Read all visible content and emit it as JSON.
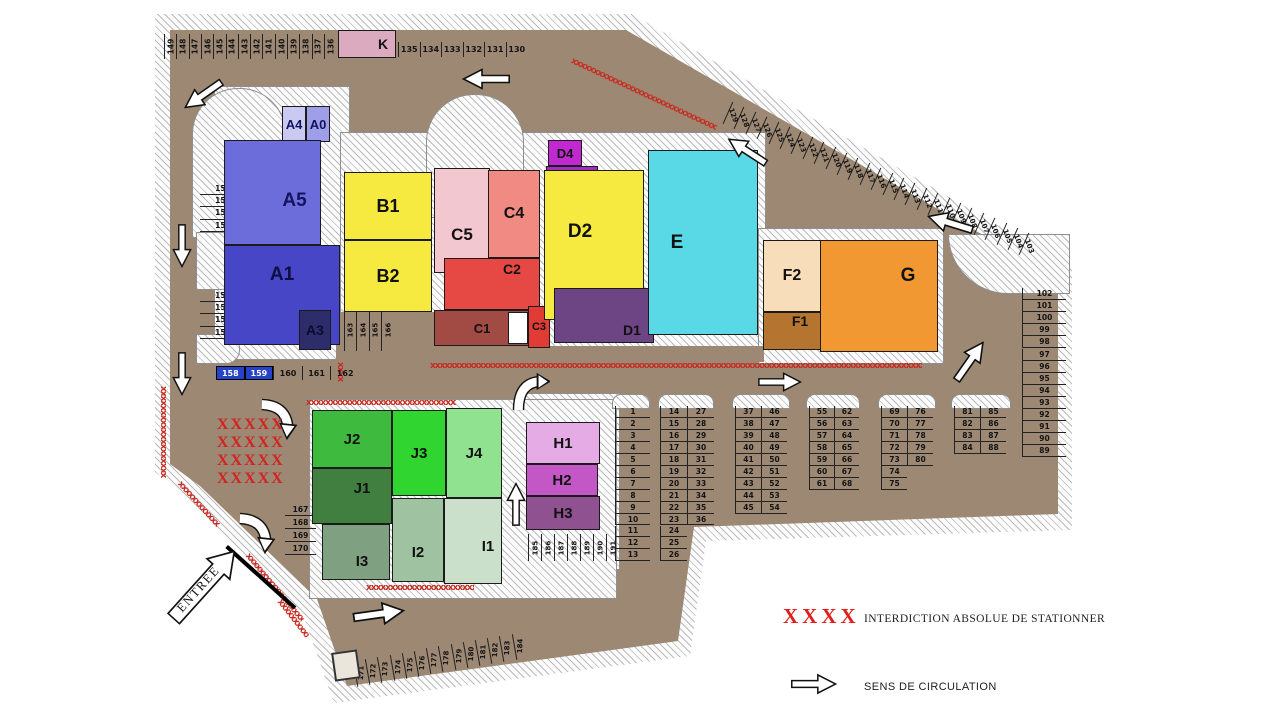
{
  "legend": {
    "no_parking_symbol": "XXXX",
    "no_parking_label": "INTERDICTION ABSOLUE DE STATIONNER",
    "direction_label": "SENS DE CIRCULATION"
  },
  "entrance_label": "ENTREE",
  "no_parking_rows": [
    "XXXXX",
    "XXXXX",
    "XXXXX",
    "XXXXX"
  ],
  "colors": {
    "road": "#9c8873",
    "no_parking_red": "#c92a21",
    "legend_red": "#e21d1d",
    "reserved_spot_blue": "#2642c8"
  },
  "buildings": [
    {
      "id": "A4",
      "label": "A4",
      "x": 282,
      "y": 106,
      "w": 24,
      "h": 36,
      "bg": "#c9c9f1",
      "fg": "#14145e",
      "fs": 13
    },
    {
      "id": "A0",
      "label": "A0",
      "x": 306,
      "y": 106,
      "w": 24,
      "h": 36,
      "bg": "#9e9ee9",
      "fg": "#14145e",
      "fs": 13
    },
    {
      "id": "A5",
      "label": "A5",
      "x": 224,
      "y": 140,
      "w": 97,
      "h": 105,
      "bg": "#6c6cdb",
      "fg": "#14145e",
      "fs": 19,
      "dx": 22,
      "dy": 8
    },
    {
      "id": "A1",
      "label": "A1",
      "x": 224,
      "y": 245,
      "w": 116,
      "h": 100,
      "bg": "#4646c6",
      "fg": "#0f0f40",
      "fs": 19,
      "dy": -20
    },
    {
      "id": "A3",
      "label": "A3",
      "x": 299,
      "y": 310,
      "w": 32,
      "h": 40,
      "bg": "#2d2d6b",
      "fg": "#0b0b30",
      "fs": 14
    },
    {
      "id": "B1",
      "label": "B1",
      "x": 344,
      "y": 172,
      "w": 88,
      "h": 68,
      "bg": "#f6e93f",
      "fg": "#111111",
      "fs": 18
    },
    {
      "id": "B2",
      "label": "B2",
      "x": 344,
      "y": 240,
      "w": 88,
      "h": 72,
      "bg": "#f6e93f",
      "fg": "#111111",
      "fs": 18
    },
    {
      "id": "C5",
      "label": "C5",
      "x": 434,
      "y": 168,
      "w": 56,
      "h": 105,
      "bg": "#f3c7cf",
      "fg": "#111111",
      "fs": 17,
      "dy": 14
    },
    {
      "id": "C4",
      "label": "C4",
      "x": 488,
      "y": 170,
      "w": 52,
      "h": 88,
      "bg": "#f28a84",
      "fg": "#111111",
      "fs": 16
    },
    {
      "id": "C2",
      "label": "C2",
      "x": 444,
      "y": 258,
      "w": 96,
      "h": 52,
      "bg": "#e64843",
      "fg": "#111111",
      "fs": 14,
      "dx": 20,
      "dy": -15
    },
    {
      "id": "C1",
      "label": "C1",
      "x": 434,
      "y": 310,
      "w": 96,
      "h": 36,
      "bg": "#a24a44",
      "fg": "#111111",
      "fs": 13
    },
    {
      "id": "GAP",
      "label": "",
      "x": 508,
      "y": 312,
      "w": 20,
      "h": 32,
      "bg": "#ffffff"
    },
    {
      "id": "C3",
      "label": "C3",
      "x": 528,
      "y": 306,
      "w": 22,
      "h": 42,
      "bg": "#e03b35",
      "fg": "#111111",
      "fs": 11
    },
    {
      "id": "D4",
      "label": "D4",
      "x": 548,
      "y": 140,
      "w": 34,
      "h": 26,
      "bg": "#bf29cf",
      "fg": "#111111",
      "fs": 13
    },
    {
      "id": "D4b",
      "label": "",
      "x": 546,
      "y": 166,
      "w": 52,
      "h": 22,
      "bg": "#a12cc0"
    },
    {
      "id": "D2",
      "label": "D2",
      "x": 544,
      "y": 170,
      "w": 100,
      "h": 150,
      "bg": "#f6e93f",
      "fg": "#111111",
      "fs": 19,
      "dx": -14,
      "dy": -13
    },
    {
      "id": "D1",
      "label": "D1",
      "x": 554,
      "y": 288,
      "w": 100,
      "h": 55,
      "bg": "#6d4585",
      "fg": "#101010",
      "fs": 14,
      "dx": 28,
      "dy": 14
    },
    {
      "id": "E",
      "label": "E",
      "x": 648,
      "y": 150,
      "w": 110,
      "h": 185,
      "bg": "#59d9e6",
      "fg": "#111111",
      "fs": 19,
      "dx": -26
    },
    {
      "id": "F2",
      "label": "F2",
      "x": 763,
      "y": 240,
      "w": 58,
      "h": 72,
      "bg": "#f7ddb9",
      "fg": "#111111",
      "fs": 16
    },
    {
      "id": "F1",
      "label": "F1",
      "x": 763,
      "y": 312,
      "w": 58,
      "h": 38,
      "bg": "#b5742f",
      "fg": "#111111",
      "fs": 14,
      "dx": 8,
      "dy": -10
    },
    {
      "id": "G",
      "label": "G",
      "x": 820,
      "y": 240,
      "w": 118,
      "h": 112,
      "bg": "#f29833",
      "fg": "#111111",
      "fs": 19,
      "dx": 29,
      "dy": -20
    },
    {
      "id": "K",
      "label": "K",
      "x": 338,
      "y": 30,
      "w": 58,
      "h": 28,
      "bg": "#dcaabe",
      "fg": "#111111",
      "fs": 14,
      "dx": 16
    },
    {
      "id": "H1",
      "label": "H1",
      "x": 526,
      "y": 422,
      "w": 74,
      "h": 42,
      "bg": "#e4abe4",
      "fg": "#111111",
      "fs": 15
    },
    {
      "id": "H2",
      "label": "H2",
      "x": 526,
      "y": 464,
      "w": 72,
      "h": 32,
      "bg": "#c457c6",
      "fg": "#111111",
      "fs": 15
    },
    {
      "id": "H3",
      "label": "H3",
      "x": 526,
      "y": 496,
      "w": 74,
      "h": 34,
      "bg": "#8f518f",
      "fg": "#111111",
      "fs": 15
    },
    {
      "id": "J2",
      "label": "J2",
      "x": 312,
      "y": 410,
      "w": 80,
      "h": 58,
      "bg": "#3eba3e",
      "fg": "#111111",
      "fs": 15
    },
    {
      "id": "J3",
      "label": "J3",
      "x": 392,
      "y": 410,
      "w": 54,
      "h": 86,
      "bg": "#30d530",
      "fg": "#111111",
      "fs": 15
    },
    {
      "id": "J4",
      "label": "J4",
      "x": 446,
      "y": 408,
      "w": 56,
      "h": 90,
      "bg": "#90e190",
      "fg": "#111111",
      "fs": 15
    },
    {
      "id": "J1",
      "label": "J1",
      "x": 312,
      "y": 468,
      "w": 80,
      "h": 56,
      "bg": "#407f40",
      "fg": "#111111",
      "fs": 15,
      "dx": 10,
      "dy": -8
    },
    {
      "id": "I3",
      "label": "I3",
      "x": 322,
      "y": 524,
      "w": 68,
      "h": 56,
      "bg": "#80a181",
      "fg": "#111111",
      "fs": 15,
      "dx": 6,
      "dy": 9
    },
    {
      "id": "I2",
      "label": "I2",
      "x": 392,
      "y": 498,
      "w": 52,
      "h": 84,
      "bg": "#9fc3a0",
      "fg": "#111111",
      "fs": 15,
      "dy": 12
    },
    {
      "id": "I1",
      "label": "I1",
      "x": 444,
      "y": 498,
      "w": 58,
      "h": 86,
      "bg": "#cbe0cb",
      "fg": "#111111",
      "fs": 15,
      "dx": 15,
      "dy": 5
    }
  ],
  "parking_groups": [
    {
      "name": "top-row-west",
      "numbers": [
        149,
        148,
        147,
        146,
        145,
        144,
        143,
        142,
        141,
        140,
        139,
        138,
        137,
        136
      ],
      "x": 164,
      "y": 34,
      "dx": 12.3,
      "dy": 0,
      "w": 12.3,
      "h": 25,
      "textRot": -90,
      "line": "left"
    },
    {
      "name": "top-row-east",
      "numbers": [
        135,
        134,
        133,
        132,
        131,
        130
      ],
      "x": 398,
      "y": 42,
      "dx": 21.5,
      "dy": 0,
      "w": 21.5,
      "h": 15,
      "line": "left",
      "fs": 8
    },
    {
      "name": "diagonal-north",
      "numbers": [
        129,
        128,
        127,
        126,
        125,
        124,
        123,
        122,
        121,
        120,
        119,
        118,
        117,
        116,
        115,
        114,
        113,
        112,
        111,
        110,
        109,
        108,
        107,
        106,
        105,
        104,
        103
      ],
      "x": 727,
      "y": 103,
      "dx": 11.4,
      "dy": 5.05,
      "w": 11.4,
      "h": 24,
      "cellRot": 24,
      "textRot": 46,
      "line": "left",
      "fs": 7
    },
    {
      "name": "west-150",
      "numbers": [
        150,
        151,
        152,
        153
      ],
      "x": 200,
      "y": 183,
      "dx": 0,
      "dy": 12.2,
      "w": 46,
      "h": 12.2,
      "line": "bottom"
    },
    {
      "name": "west-154",
      "numbers": [
        154,
        155,
        156,
        157
      ],
      "x": 200,
      "y": 290,
      "dx": 0,
      "dy": 12.2,
      "w": 46,
      "h": 12.2,
      "line": "bottom"
    },
    {
      "name": "row-158",
      "numbers": [
        158,
        159,
        160,
        161,
        162
      ],
      "x": 216,
      "y": 366,
      "dx": 28.6,
      "dy": 0,
      "w": 28.6,
      "h": 14,
      "line": "left",
      "fs": 8,
      "specials": {
        "158": {
          "bg": "#2642c8",
          "fg": "#ffffff"
        },
        "159": {
          "bg": "#2642c8",
          "fg": "#ffffff"
        }
      }
    },
    {
      "name": "under-B2",
      "numbers": [
        163,
        164,
        165,
        166
      ],
      "x": 344,
      "y": 309,
      "dx": 12.4,
      "dy": 0,
      "w": 12.4,
      "h": 42,
      "textRot": -90,
      "line": "left",
      "fs": 7
    },
    {
      "name": "west-167",
      "numbers": [
        167,
        168,
        169,
        170
      ],
      "x": 285,
      "y": 503,
      "dx": 0,
      "dy": 13,
      "w": 31,
      "h": 13,
      "line": "bottom"
    },
    {
      "name": "south-strip",
      "numbers": [
        171,
        172,
        173,
        174,
        175,
        176,
        177,
        178,
        179,
        180,
        181,
        182,
        183,
        184
      ],
      "x": 355,
      "y": 660,
      "dx": 12.2,
      "dy": -2.1,
      "w": 12.2,
      "h": 26,
      "cellRot": -10,
      "textRot": -78,
      "line": "left",
      "fs": 7
    },
    {
      "name": "under-H",
      "numbers": [
        185,
        186,
        187,
        188,
        189,
        190,
        191
      ],
      "x": 528,
      "y": 534,
      "dx": 13,
      "dy": 0,
      "w": 13,
      "h": 27,
      "textRot": -90,
      "line": "left",
      "fs": 7
    },
    {
      "name": "east-column",
      "numbers": [
        102,
        101,
        100,
        99,
        98,
        97,
        96,
        95,
        94,
        93,
        92,
        91,
        90,
        89
      ],
      "x": 1022,
      "y": 288,
      "dx": 0,
      "dy": 12.1,
      "w": 44,
      "h": 12.1,
      "line": "bottom-left"
    },
    {
      "name": "grid-col-1",
      "numbers": [
        1,
        2,
        3,
        4,
        5,
        6,
        7,
        8,
        9,
        10,
        11,
        12,
        13
      ],
      "x": 615,
      "y": 406,
      "dx": 0,
      "dy": 11.95,
      "w": 35,
      "h": 11.95,
      "line": "bottom-left"
    },
    {
      "name": "grid-col-14",
      "numbers": [
        14,
        15,
        16,
        17,
        18,
        19,
        20,
        21,
        22,
        23,
        24,
        25,
        26
      ],
      "x": 660,
      "y": 406,
      "dx": 0,
      "dy": 11.95,
      "w": 27,
      "h": 11.95,
      "line": "bottom-left"
    },
    {
      "name": "grid-col-27",
      "numbers": [
        27,
        28,
        29,
        30,
        31,
        32,
        33,
        34,
        35,
        36
      ],
      "x": 687,
      "y": 406,
      "dx": 0,
      "dy": 11.95,
      "w": 27,
      "h": 11.95,
      "line": "bottom-left"
    },
    {
      "name": "grid-col-37",
      "numbers": [
        37,
        38,
        39,
        40,
        41,
        42,
        43,
        44,
        45
      ],
      "x": 735,
      "y": 406,
      "dx": 0,
      "dy": 11.95,
      "w": 26,
      "h": 11.95,
      "line": "bottom-left"
    },
    {
      "name": "grid-col-46",
      "numbers": [
        46,
        47,
        48,
        49,
        50,
        51,
        52,
        53,
        54
      ],
      "x": 761,
      "y": 406,
      "dx": 0,
      "dy": 11.95,
      "w": 26,
      "h": 11.95,
      "line": "bottom-left"
    },
    {
      "name": "grid-col-55",
      "numbers": [
        55,
        56,
        57,
        58,
        59,
        60,
        61
      ],
      "x": 809,
      "y": 406,
      "dx": 0,
      "dy": 11.95,
      "w": 25,
      "h": 11.95,
      "line": "bottom-left"
    },
    {
      "name": "grid-col-62",
      "numbers": [
        62,
        63,
        64,
        65,
        66,
        67,
        68
      ],
      "x": 834,
      "y": 406,
      "dx": 0,
      "dy": 11.95,
      "w": 25,
      "h": 11.95,
      "line": "bottom-left"
    },
    {
      "name": "grid-col-69",
      "numbers": [
        69,
        70,
        71,
        72,
        73,
        74,
        75
      ],
      "x": 881,
      "y": 406,
      "dx": 0,
      "dy": 11.95,
      "w": 26,
      "h": 11.95,
      "line": "bottom-left"
    },
    {
      "name": "grid-col-76",
      "numbers": [
        76,
        77,
        78,
        79,
        80
      ],
      "x": 907,
      "y": 406,
      "dx": 0,
      "dy": 11.95,
      "w": 26,
      "h": 11.95,
      "line": "bottom-left"
    },
    {
      "name": "grid-col-81",
      "numbers": [
        81,
        82,
        83,
        84
      ],
      "x": 954,
      "y": 406,
      "dx": 0,
      "dy": 11.95,
      "w": 26,
      "h": 11.95,
      "line": "bottom-left"
    },
    {
      "name": "grid-col-85",
      "numbers": [
        85,
        86,
        87,
        88
      ],
      "x": 980,
      "y": 406,
      "dx": 0,
      "dy": 11.95,
      "w": 26,
      "h": 11.95,
      "line": "bottom-left"
    }
  ],
  "arrows": [
    {
      "x": 180,
      "y": 84,
      "w": 46,
      "h": 22,
      "rot": 145,
      "type": "straight"
    },
    {
      "x": 462,
      "y": 68,
      "w": 48,
      "h": 22,
      "rot": 180,
      "type": "straight"
    },
    {
      "x": 724,
      "y": 140,
      "w": 46,
      "h": 22,
      "rot": 213,
      "type": "straight"
    },
    {
      "x": 926,
      "y": 212,
      "w": 48,
      "h": 22,
      "rot": 197,
      "type": "straight"
    },
    {
      "x": 758,
      "y": 372,
      "w": 44,
      "h": 20,
      "rot": 0,
      "type": "straight"
    },
    {
      "x": 160,
      "y": 236,
      "w": 44,
      "h": 20,
      "rot": 90,
      "type": "straight"
    },
    {
      "x": 160,
      "y": 364,
      "w": 44,
      "h": 20,
      "rot": 90,
      "type": "straight"
    },
    {
      "x": 258,
      "y": 392,
      "w": 48,
      "h": 50,
      "rot": 0,
      "type": "curve-dr"
    },
    {
      "x": 236,
      "y": 506,
      "w": 48,
      "h": 50,
      "rot": 0,
      "type": "curve-dr"
    },
    {
      "x": 348,
      "y": 602,
      "w": 62,
      "h": 24,
      "rot": -8,
      "type": "straight"
    },
    {
      "x": 488,
      "y": 494,
      "w": 56,
      "h": 20,
      "rot": -90,
      "type": "straight"
    },
    {
      "x": 946,
      "y": 350,
      "w": 48,
      "h": 22,
      "rot": -55,
      "type": "straight"
    },
    {
      "x": 508,
      "y": 370,
      "w": 42,
      "h": 42,
      "rot": 0,
      "type": "curve-ur"
    },
    {
      "x": 791,
      "y": 672,
      "w": 46,
      "h": 24,
      "rot": 0,
      "type": "straight"
    }
  ],
  "marks": [
    {
      "x": 573,
      "y": 57,
      "len": 160,
      "rot": 25
    },
    {
      "x": 430,
      "y": 362,
      "len": 492,
      "rot": 0
    },
    {
      "x": 167,
      "y": 386,
      "len": 92,
      "rot": 90
    },
    {
      "x": 182,
      "y": 480,
      "len": 58,
      "rot": 48
    },
    {
      "x": 250,
      "y": 552,
      "len": 86,
      "rot": 50
    },
    {
      "x": 282,
      "y": 598,
      "len": 46,
      "rot": 52
    },
    {
      "x": 306,
      "y": 399,
      "len": 150,
      "rot": 0
    },
    {
      "x": 366,
      "y": 584,
      "len": 108,
      "rot": 0
    },
    {
      "x": 344,
      "y": 362,
      "len": 20,
      "rot": 90
    }
  ]
}
